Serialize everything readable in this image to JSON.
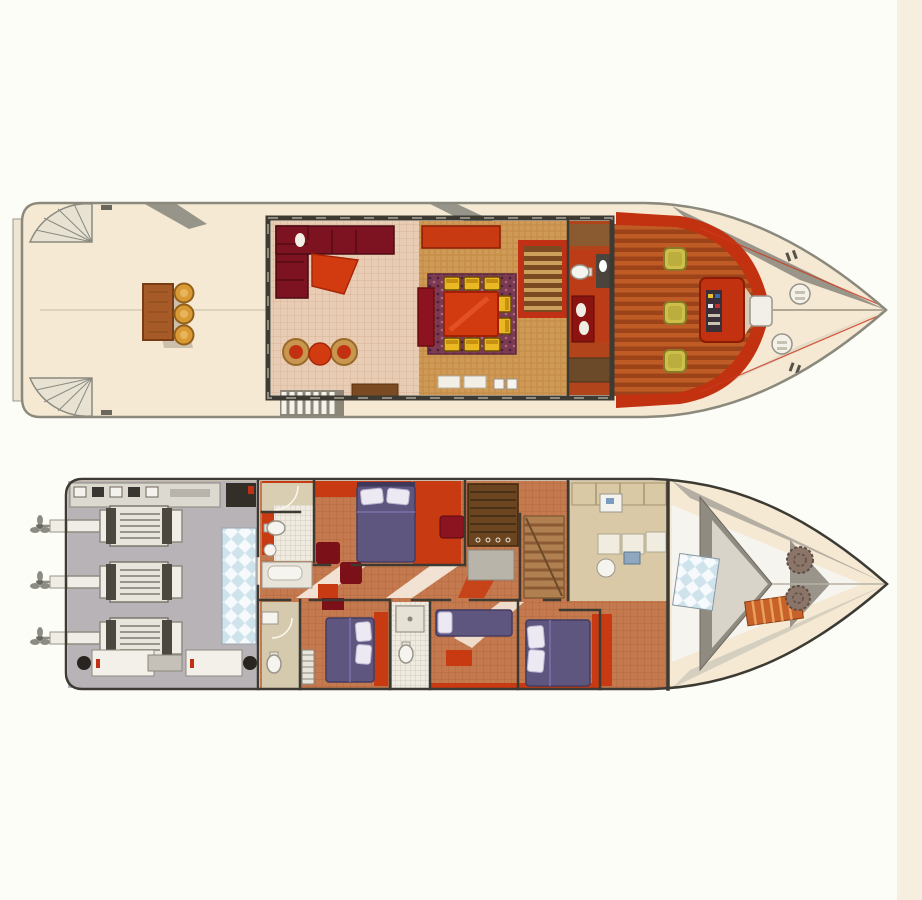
{
  "image_type": "motor-yacht deck plan illustration, two decks, bow pointing right, no text labels",
  "palette": {
    "background": "#fdfdf8",
    "page_edge": "#f6efdf",
    "deck_cream": "#f5e9d4",
    "hull_line": "#8b887c",
    "dark_wall": "#3c3a32",
    "aft_stair": "#e8e2d2",
    "table_wood": "#a55a28",
    "stool_gold": "#d99a33",
    "salon_tile": "#e8cdb4",
    "tile_line": "#d8b49a",
    "sofa_burgundy": "#7d1320",
    "red_furniture": "#d23a10",
    "wicker_floor": "#cf9a55",
    "wicker_line": "#b87f3a",
    "rug_purple": "#7c3a52",
    "chair_yellow": "#e9b822",
    "stair_red_frame": "#c03014",
    "head_floor": "#bc3c18",
    "plank_light": "#bf5c26",
    "plank_dark": "#9c431a",
    "bulwark_red": "#c23210",
    "helm_chair": "#cdbf4a",
    "engine_floor": "#b7b3b7",
    "engine_white": "#efede6",
    "tank_blue": "#cfe3ec",
    "terra_floor": "#c47a4e",
    "terra_line": "#ad6038",
    "bed_purple": "#5f5680",
    "pillow_white": "#ece9f2",
    "accent_red": "#c83a12",
    "maroon": "#8c1420",
    "wardrobe_brown": "#6b451f",
    "galley_beige": "#d9c9a6",
    "bulkhead_gray": "#8f8b80",
    "chain_brown": "#8a7568",
    "ladder_orange": "#c8622a"
  },
  "main_deck": {
    "regions": [
      "swim-platform",
      "aft-deck",
      "salon",
      "dining-area",
      "companionway-stairs",
      "day-head",
      "wheelhouse",
      "foredeck"
    ],
    "aft_deck": {
      "corner_stair_fans": 2,
      "tables": 1,
      "stools": 3
    },
    "salon": {
      "l_shaped_sofa": 1,
      "coffee_tables": 1,
      "wicker_armchairs": 2,
      "round_tables": 1,
      "stair_treads": 7
    },
    "dining_area": {
      "tables": 1,
      "chairs": 8,
      "bench_settees": 2,
      "rug": 1,
      "sideboard_cabinets": 2
    },
    "day_head": {
      "toilets": 1,
      "vanities": 1
    },
    "wheelhouse": {
      "helm_chairs": 3,
      "consoles": 1
    },
    "foredeck": {
      "deck_hatches": 2,
      "windlass": 1,
      "cleat_pairs": 2
    }
  },
  "lower_deck": {
    "regions": [
      "propellers",
      "engine-room",
      "bathrooms",
      "master-cabin",
      "corridor",
      "guest-cabins",
      "wardrobe",
      "staircase",
      "galley-pantry",
      "forward-cabin",
      "forepeak"
    ],
    "engine_room": {
      "engines": 3,
      "propeller_shafts": 3,
      "generators": 2,
      "checkered_tanks": 2,
      "control_panel": 1
    },
    "cabins": {
      "double_beds": 3,
      "single_berths": 1,
      "armchairs": 3
    },
    "bathrooms": 3,
    "forepeak": {
      "ladders": 1,
      "anchor_chain_coils": 2,
      "bulkheads": 2
    }
  }
}
